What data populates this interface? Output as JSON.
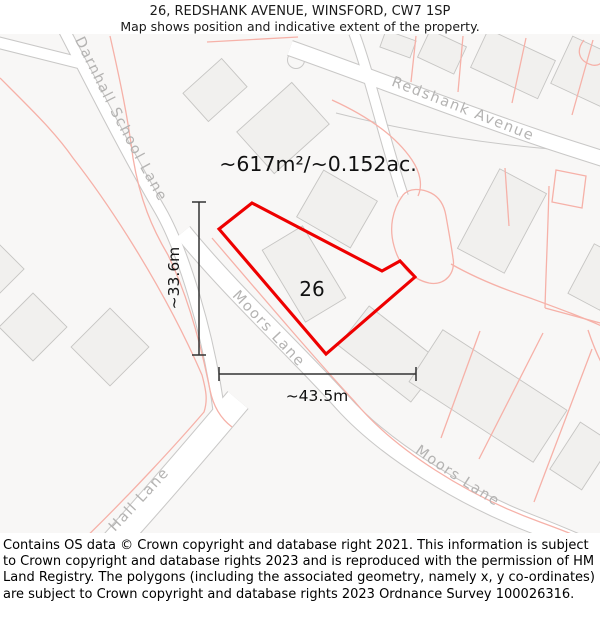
{
  "header": {
    "title": "26, REDSHANK AVENUE, WINSFORD, CW7 1SP",
    "subtitle": "Map shows position and indicative extent of the property."
  },
  "map": {
    "area_label": "~617m²/~0.152ac.",
    "plot_number": "26",
    "dimensions": {
      "height": "~33.6m",
      "width": "~43.5m"
    },
    "streets": {
      "darnhall_school_lane": "Darnhall School Lane",
      "redshank_avenue": "Redshank Avenue",
      "moors_lane_upper": "Moors Lane",
      "moors_lane_lower": "Moors Lane",
      "hall_lane": "Hall Lane"
    },
    "colors": {
      "property_outline": "#ee0000",
      "parcel_line": "#f6b1a8",
      "road_casing": "#c9c8c7",
      "road_fill": "#ffffff",
      "building_fill": "#f1f0ee",
      "street_label": "#b4b3b2",
      "map_background": "#f8f7f6"
    }
  },
  "footer": {
    "attribution": "Contains OS data © Crown copyright and database right 2021. This information is subject to Crown copyright and database rights 2023 and is reproduced with the permission of HM Land Registry. The polygons (including the associated geometry, namely x, y co-ordinates) are subject to Crown copyright and database rights 2023 Ordnance Survey 100026316."
  }
}
